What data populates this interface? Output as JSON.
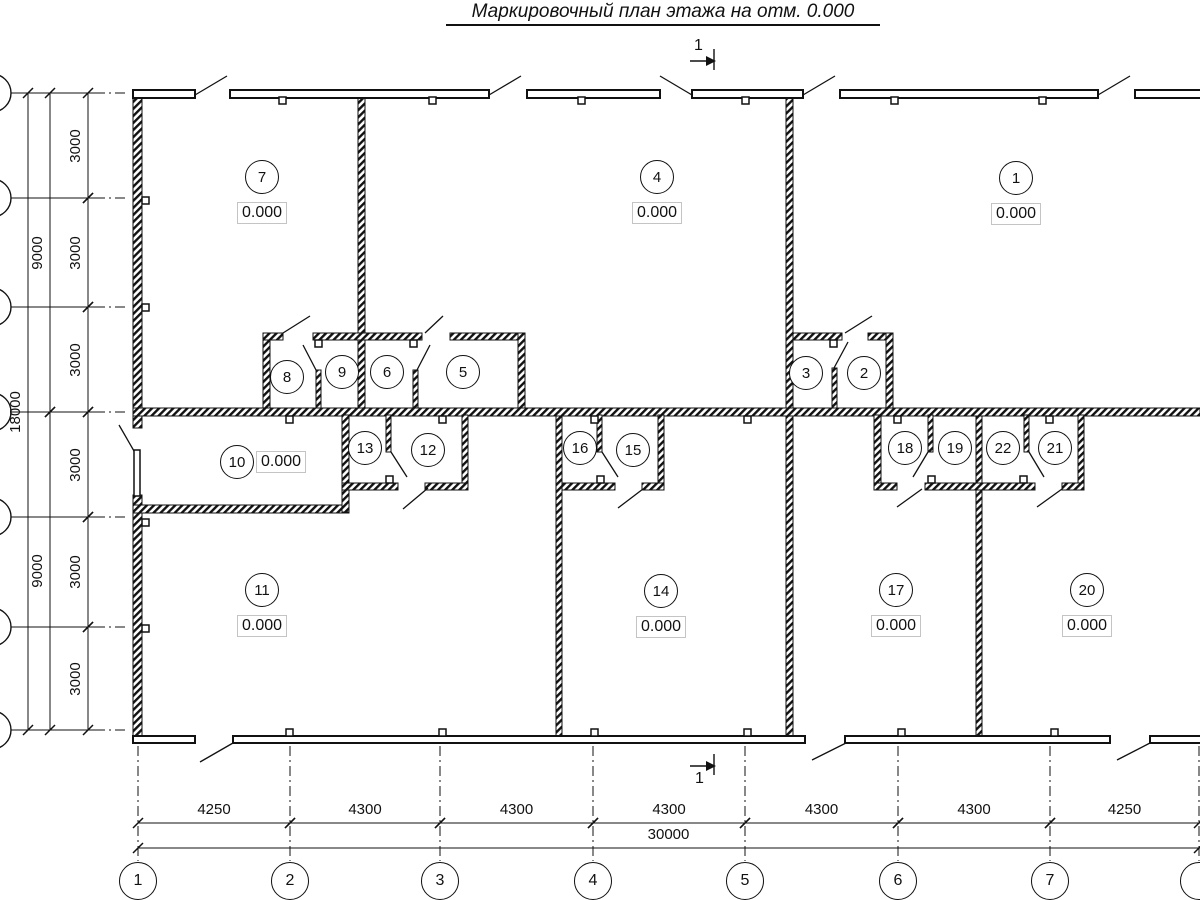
{
  "title": "Маркировочный план этажа на отм. 0.000",
  "elevation_value": "0.000",
  "rooms": [
    {
      "num": "7",
      "cx": 262,
      "cy": 177,
      "elev": "0.000",
      "elev_side": "below"
    },
    {
      "num": "4",
      "cx": 657,
      "cy": 177,
      "elev": "0.000",
      "elev_side": "below"
    },
    {
      "num": "1",
      "cx": 1016,
      "cy": 178,
      "elev": "0.000",
      "elev_side": "below"
    },
    {
      "num": "8",
      "cx": 287,
      "cy": 377
    },
    {
      "num": "9",
      "cx": 342,
      "cy": 372
    },
    {
      "num": "6",
      "cx": 387,
      "cy": 372
    },
    {
      "num": "5",
      "cx": 463,
      "cy": 372
    },
    {
      "num": "3",
      "cx": 806,
      "cy": 373
    },
    {
      "num": "2",
      "cx": 864,
      "cy": 373
    },
    {
      "num": "10",
      "cx": 237,
      "cy": 462,
      "elev": "0.000",
      "elev_side": "right"
    },
    {
      "num": "13",
      "cx": 365,
      "cy": 448
    },
    {
      "num": "12",
      "cx": 428,
      "cy": 450
    },
    {
      "num": "16",
      "cx": 580,
      "cy": 448
    },
    {
      "num": "15",
      "cx": 633,
      "cy": 450
    },
    {
      "num": "18",
      "cx": 905,
      "cy": 448
    },
    {
      "num": "19",
      "cx": 955,
      "cy": 448
    },
    {
      "num": "22",
      "cx": 1003,
      "cy": 448
    },
    {
      "num": "21",
      "cx": 1055,
      "cy": 448
    },
    {
      "num": "11",
      "cx": 262,
      "cy": 590,
      "elev": "0.000",
      "elev_side": "below"
    },
    {
      "num": "14",
      "cx": 661,
      "cy": 591,
      "elev": "0.000",
      "elev_side": "below"
    },
    {
      "num": "17",
      "cx": 896,
      "cy": 590,
      "elev": "0.000",
      "elev_side": "below"
    },
    {
      "num": "20",
      "cx": 1087,
      "cy": 590,
      "elev": "0.000",
      "elev_side": "below"
    }
  ],
  "bottom_axes": [
    {
      "label": "1",
      "x": 138
    },
    {
      "label": "2",
      "x": 290
    },
    {
      "label": "3",
      "x": 440
    },
    {
      "label": "4",
      "x": 593
    },
    {
      "label": "5",
      "x": 745
    },
    {
      "label": "6",
      "x": 898
    },
    {
      "label": "7",
      "x": 1050
    },
    {
      "label": "",
      "x": 1199
    }
  ],
  "bottom_dims": {
    "y": 823,
    "segments": [
      {
        "label": "4250",
        "from": 138,
        "to": 290
      },
      {
        "label": "4300",
        "from": 290,
        "to": 440
      },
      {
        "label": "4300",
        "from": 440,
        "to": 593
      },
      {
        "label": "4300",
        "from": 593,
        "to": 745
      },
      {
        "label": "4300",
        "from": 745,
        "to": 898
      },
      {
        "label": "4300",
        "from": 898,
        "to": 1050
      },
      {
        "label": "4250",
        "from": 1050,
        "to": 1199
      }
    ],
    "total": {
      "label": "30000",
      "from": 138,
      "to": 1199,
      "y": 848
    }
  },
  "left_dims": {
    "columns": [
      {
        "x": 88,
        "segments": [
          {
            "label": "3000",
            "from": 93,
            "to": 198
          },
          {
            "label": "3000",
            "from": 198,
            "to": 307
          },
          {
            "label": "3000",
            "from": 307,
            "to": 412
          },
          {
            "label": "3000",
            "from": 412,
            "to": 517
          },
          {
            "label": "3000",
            "from": 517,
            "to": 627
          },
          {
            "label": "3000",
            "from": 627,
            "to": 730
          }
        ]
      },
      {
        "x": 50,
        "segments": [
          {
            "label": "9000",
            "from": 93,
            "to": 412
          },
          {
            "label": "9000",
            "from": 412,
            "to": 730
          }
        ]
      },
      {
        "x": 28,
        "segments": [
          {
            "label": "18000",
            "from": 93,
            "to": 730
          }
        ]
      }
    ]
  },
  "section_marks": [
    {
      "label": "1",
      "x": 700,
      "y": 46
    },
    {
      "label": "1",
      "x": 701,
      "y": 779
    }
  ],
  "colors": {
    "line": "#111111",
    "elev_box_border": "#c4c4c4"
  }
}
